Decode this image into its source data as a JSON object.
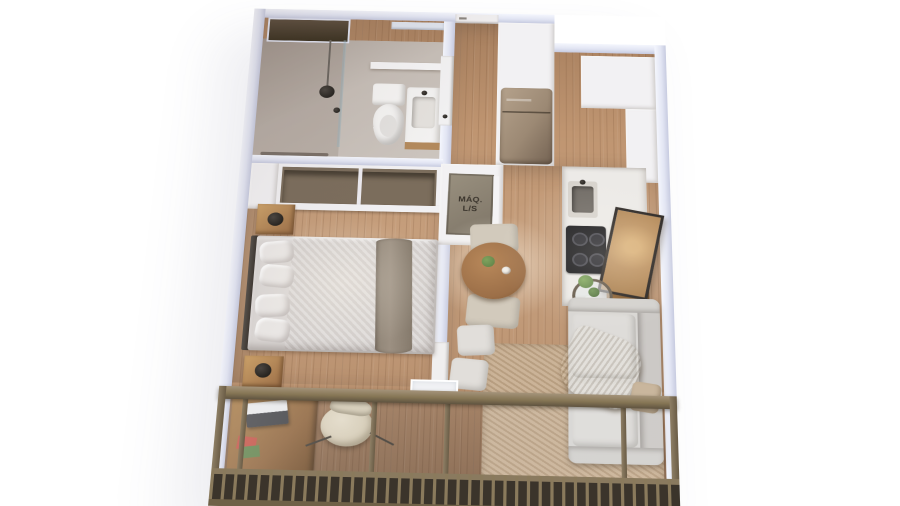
{
  "meta": {
    "view": "3d-isometric-floorplan-render",
    "unit_type": "studio-apartment-with-balcony"
  },
  "labels": {
    "laundry_closet": {
      "line1": "MÁQ.",
      "line2": "L/S"
    }
  },
  "palette": {
    "wall_cut": "#e2e5f3",
    "wood_floor": "#bf9571",
    "deck": "#aa8160",
    "tile": "#c6beb7",
    "white_furn": "#f2f1f3",
    "railing": "#867655",
    "railing_dark": "#3b342b",
    "fridge": "#9c8974",
    "cooktop": "#17171a",
    "sofa": "#d8d6d3",
    "throw": "#c8b28c",
    "rug": "#c5ac8f",
    "duvet": "#dcd8d6",
    "runner": "#9c9082",
    "pillow": "#ebe8e6",
    "closet_bg": "#7b6d5c",
    "table_wood": "#9c6f48",
    "chair": "#d2cabc",
    "art_frame": "#2a2522",
    "art_canvas": "#bd9261",
    "plant": "#5c7f46",
    "desk_wood": "#8d6138",
    "laptop": "#3c3c40",
    "lamp_black": "#171511",
    "vanity_wood": "#b2895c",
    "slab": "#d6d5dc"
  },
  "icons": {
    "shower": "shower-head-icon",
    "toilet": "toilet-icon",
    "sink": "sink-icon",
    "cooktop": "cooktop-burners-icon",
    "plant": "plant-icon"
  }
}
